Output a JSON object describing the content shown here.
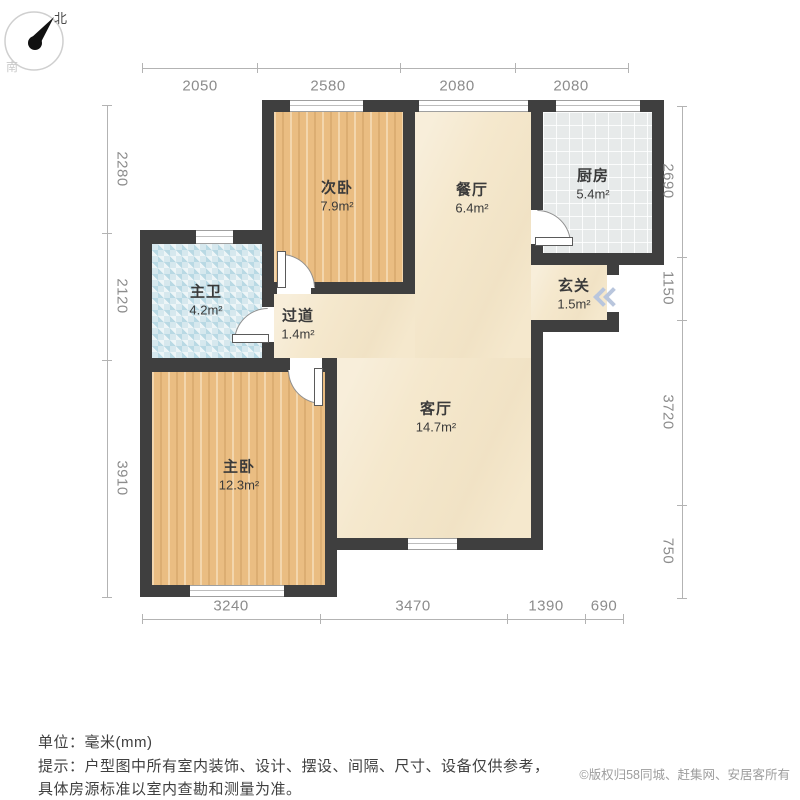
{
  "compass": {
    "north": "北",
    "south": "南"
  },
  "rooms": {
    "ciwo": {
      "name": "次卧",
      "area": "7.9m²"
    },
    "canting": {
      "name": "餐厅",
      "area": "6.4m²"
    },
    "chufang": {
      "name": "厨房",
      "area": "5.4m²"
    },
    "zhuwei": {
      "name": "主卫",
      "area": "4.2m²"
    },
    "guodao": {
      "name": "过道",
      "area": "1.4m²"
    },
    "xuanguan": {
      "name": "玄关",
      "area": "1.5m²"
    },
    "keting": {
      "name": "客厅",
      "area": "14.7m²"
    },
    "zhuwo": {
      "name": "主卧",
      "area": "12.3m²"
    }
  },
  "dimensions": {
    "top": [
      "2050",
      "2580",
      "2080",
      "2080"
    ],
    "bottom": [
      "3240",
      "3470",
      "1390",
      "690"
    ],
    "left": [
      "2280",
      "2120",
      "3910"
    ],
    "right": [
      "2690",
      "1150",
      "3720",
      "750"
    ]
  },
  "notes": {
    "unit": "单位：毫米(mm)",
    "tip_line1": "提示：户型图中所有室内装饰、设计、摆设、间隔、尺寸、设备仅供参考，",
    "tip_line2": "具体房源标准以室内查勘和测量为准。"
  },
  "copyright": "©版权归58同城、赶集网、安居客所有",
  "colors": {
    "wall": "#3f3f3f",
    "wood_floor": "#eabd82",
    "marble_floor": "#f5e8cd",
    "kitchen_tile": "#e7eaea",
    "bath_mosaic": "#d6e8ee",
    "entry_arrow": "#b9c6dd",
    "dimension_text": "#8c8c8c"
  }
}
